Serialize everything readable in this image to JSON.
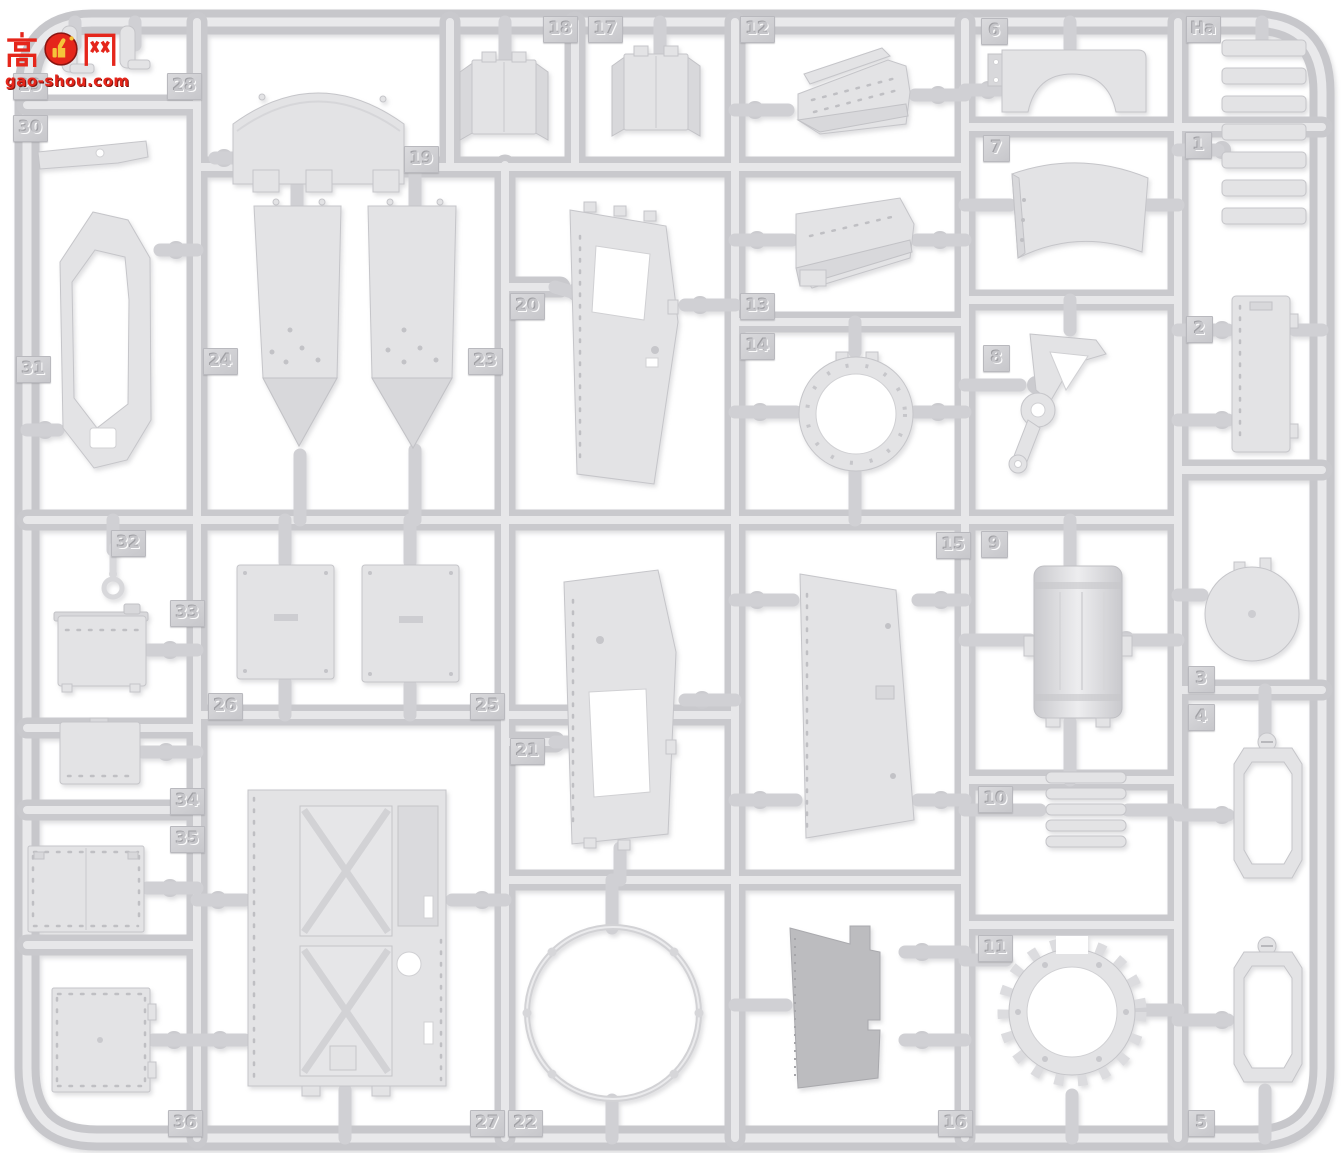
{
  "watermark": {
    "char_left": "高",
    "char_right": "网",
    "brand_full": "高手网 gao-shou.com",
    "domain": "gao-shou.com",
    "color": "#e5261b",
    "thumb_color": "#f5c33a"
  },
  "sprue": {
    "letter": "Ha",
    "plastic_color": "#d9d9db",
    "tag_color": "#cfcfd2",
    "background": "#ffffff",
    "tags": [
      {
        "label": "29",
        "x": 13,
        "y": 73
      },
      {
        "label": "30",
        "x": 13,
        "y": 115
      },
      {
        "label": "31",
        "x": 16,
        "y": 356
      },
      {
        "label": "32",
        "x": 111,
        "y": 530
      },
      {
        "label": "33",
        "x": 170,
        "y": 600
      },
      {
        "label": "34",
        "x": 170,
        "y": 788
      },
      {
        "label": "35",
        "x": 170,
        "y": 826
      },
      {
        "label": "36",
        "x": 168,
        "y": 1110
      },
      {
        "label": "28",
        "x": 167,
        "y": 73
      },
      {
        "label": "19",
        "x": 404,
        "y": 146
      },
      {
        "label": "24",
        "x": 203,
        "y": 348
      },
      {
        "label": "23",
        "x": 468,
        "y": 348
      },
      {
        "label": "26",
        "x": 208,
        "y": 693
      },
      {
        "label": "25",
        "x": 470,
        "y": 693
      },
      {
        "label": "27",
        "x": 470,
        "y": 1110
      },
      {
        "label": "22",
        "x": 508,
        "y": 1110
      },
      {
        "label": "20",
        "x": 510,
        "y": 293
      },
      {
        "label": "21",
        "x": 510,
        "y": 738
      },
      {
        "label": "18",
        "x": 543,
        "y": 16
      },
      {
        "label": "17",
        "x": 588,
        "y": 16
      },
      {
        "label": "12",
        "x": 740,
        "y": 16
      },
      {
        "label": "13",
        "x": 740,
        "y": 293
      },
      {
        "label": "14",
        "x": 740,
        "y": 333
      },
      {
        "label": "15",
        "x": 936,
        "y": 532
      },
      {
        "label": "16",
        "x": 938,
        "y": 1110
      },
      {
        "label": "6",
        "x": 981,
        "y": 18
      },
      {
        "label": "7",
        "x": 983,
        "y": 135
      },
      {
        "label": "8",
        "x": 983,
        "y": 345
      },
      {
        "label": "9",
        "x": 981,
        "y": 531
      },
      {
        "label": "10",
        "x": 978,
        "y": 786
      },
      {
        "label": "11",
        "x": 978,
        "y": 935
      },
      {
        "label": "Ha",
        "x": 1186,
        "y": 16
      },
      {
        "label": "1",
        "x": 1185,
        "y": 132
      },
      {
        "label": "2",
        "x": 1186,
        "y": 316
      },
      {
        "label": "3",
        "x": 1188,
        "y": 666
      },
      {
        "label": "4",
        "x": 1188,
        "y": 704
      },
      {
        "label": "5",
        "x": 1188,
        "y": 1110
      }
    ]
  }
}
